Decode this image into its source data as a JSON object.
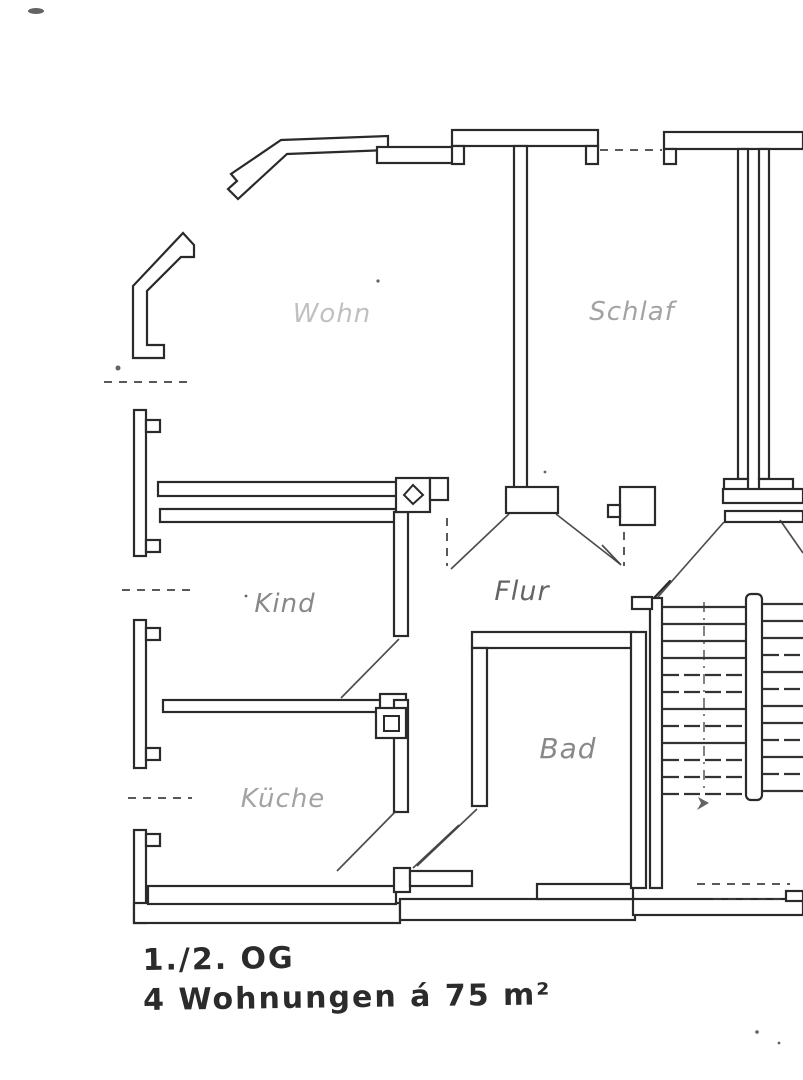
{
  "plan": {
    "rooms": {
      "living": {
        "label": "Wohn"
      },
      "bedroom": {
        "label": "Schlaf"
      },
      "child": {
        "label": "Kind"
      },
      "hallway": {
        "label": "Flur"
      },
      "bath": {
        "label": "Bad"
      },
      "kitchen": {
        "label": "Küche"
      }
    },
    "annotation": {
      "floor": "1./2. OG",
      "units": "4 Wohnungen á 75 m²"
    }
  },
  "colors": {
    "ink": "#2a2a2a",
    "faint_ink": "#8f8f8f",
    "paper": "#ffffff"
  }
}
